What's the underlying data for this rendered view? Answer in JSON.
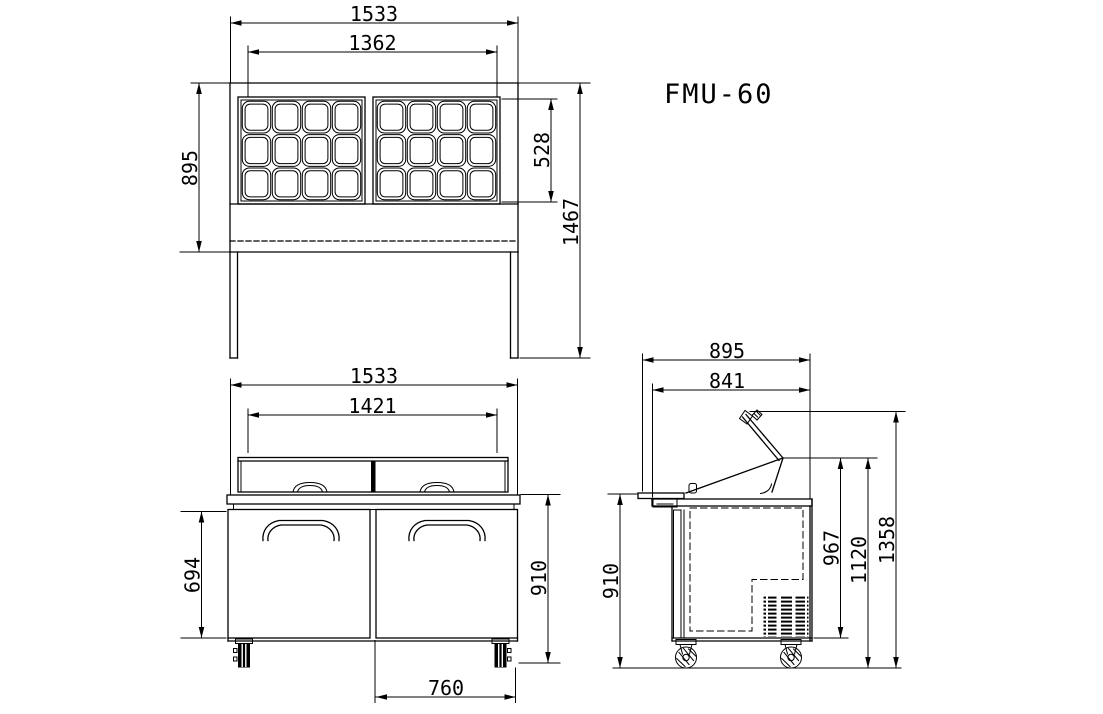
{
  "title": "FMU-60",
  "colors": {
    "line": "#000000",
    "background": "#ffffff"
  },
  "views": {
    "plan": {
      "pan_grid": {
        "groups": 2,
        "columns": 4,
        "rows": 3
      },
      "dims": {
        "overall_width": "1533",
        "pan_area_width": "1362",
        "depth": "895",
        "pan_area_depth": "528",
        "overall_height": "1467"
      }
    },
    "front": {
      "dims": {
        "overall_width": "1533",
        "hood_width": "1421",
        "door_height": "694",
        "worktop_height": "910",
        "caster_span": "760"
      }
    },
    "side": {
      "dims": {
        "overall_depth": "895",
        "worktop_depth": "841",
        "worktop_height": "910",
        "cabinet_height": "967",
        "lid_hinge_height": "1120",
        "lid_open_height": "1358"
      }
    }
  }
}
